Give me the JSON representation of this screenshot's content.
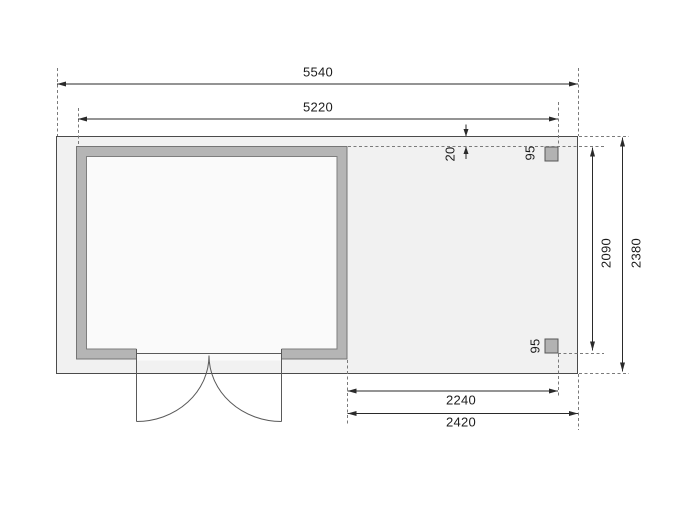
{
  "drawing": {
    "dimensions": {
      "overall_width": "5540",
      "wall_to_post_width": "5220",
      "edge_offset": "20",
      "post_width_top": "95",
      "post_width_bottom": "95",
      "post_depth": "2090",
      "overall_depth": "2380",
      "canopy_width_inner": "2240",
      "canopy_width_outer": "2420"
    },
    "colors": {
      "floor_plate_fill": "#f1f1f1",
      "wall_fill": "#b5b5b5",
      "interior_fill": "#fafafa",
      "post_fill": "#b2b2b2",
      "dimension_line": "#2a2a2a",
      "extension_line": "#7a7a7a"
    }
  }
}
